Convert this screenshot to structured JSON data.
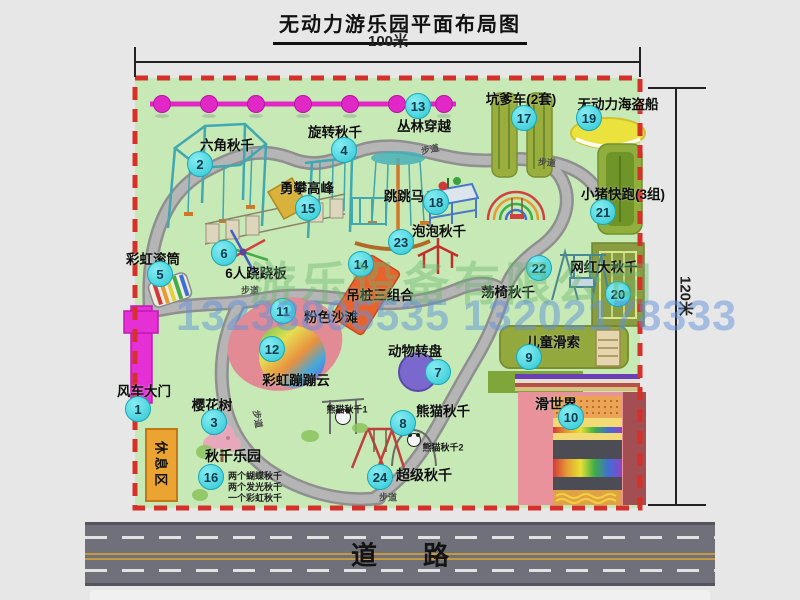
{
  "title": "无动力游乐园平面布局图",
  "dimensions": {
    "width": "100米",
    "height": "120米"
  },
  "road": {
    "label": "道路"
  },
  "walkway_label": "步道",
  "rest_area_label": "休息区",
  "watermark": {
    "company": "游乐设备有限公司",
    "phone": "13233805535 13202178333"
  },
  "items": {
    "i1": {
      "num": "1",
      "label": "风车大门"
    },
    "i2": {
      "num": "2",
      "label": "六角秋千"
    },
    "i3": {
      "num": "3",
      "label": "樱花树"
    },
    "i4": {
      "num": "4",
      "label": "旋转秋千"
    },
    "i5": {
      "num": "5",
      "label": "彩虹滚筒"
    },
    "i6": {
      "num": "6",
      "label": "6人跷跷板"
    },
    "i7": {
      "num": "7",
      "label": "动物转盘"
    },
    "i8": {
      "num": "8",
      "label": "熊猫秋千",
      "sub1": "熊猫秋千1",
      "sub2": "熊猫秋千2"
    },
    "i9": {
      "num": "9",
      "label": "儿童滑索"
    },
    "i10": {
      "num": "10",
      "label": "滑世界"
    },
    "i11": {
      "num": "11",
      "label": "粉色沙滩"
    },
    "i12": {
      "num": "12",
      "label": "彩虹蹦蹦云"
    },
    "i13": {
      "num": "13",
      "label": "丛林穿越"
    },
    "i14": {
      "num": "14",
      "label": "吊桩三组合"
    },
    "i15": {
      "num": "15",
      "label": "勇攀高峰"
    },
    "i16": {
      "num": "16",
      "label": "秋千乐园",
      "note1": "两个蝴蝶秋千",
      "note2": "两个发光秋千",
      "note3": "一个彩虹秋千"
    },
    "i17": {
      "num": "17",
      "label": "坑爹车(2套)"
    },
    "i18": {
      "num": "18",
      "label": "跳跳马"
    },
    "i19": {
      "num": "19",
      "label": "无动力海盗船"
    },
    "i20": {
      "num": "20",
      "label": "网红大秋千"
    },
    "i21": {
      "num": "21",
      "label": "小猪快跑(3组)"
    },
    "i22": {
      "num": "22",
      "label": "荡椅秋千"
    },
    "i23": {
      "num": "23",
      "label": "泡泡秋千"
    },
    "i24": {
      "num": "24",
      "label": "超级秋千"
    }
  },
  "colors": {
    "park_green": "#c6e9b5",
    "border_red": "#d5302a",
    "path_gray": "#a2a2a2",
    "badge_cyan": "#2fc8d4",
    "gate_magenta": "#e530d6",
    "road_gray": "#70707a"
  }
}
